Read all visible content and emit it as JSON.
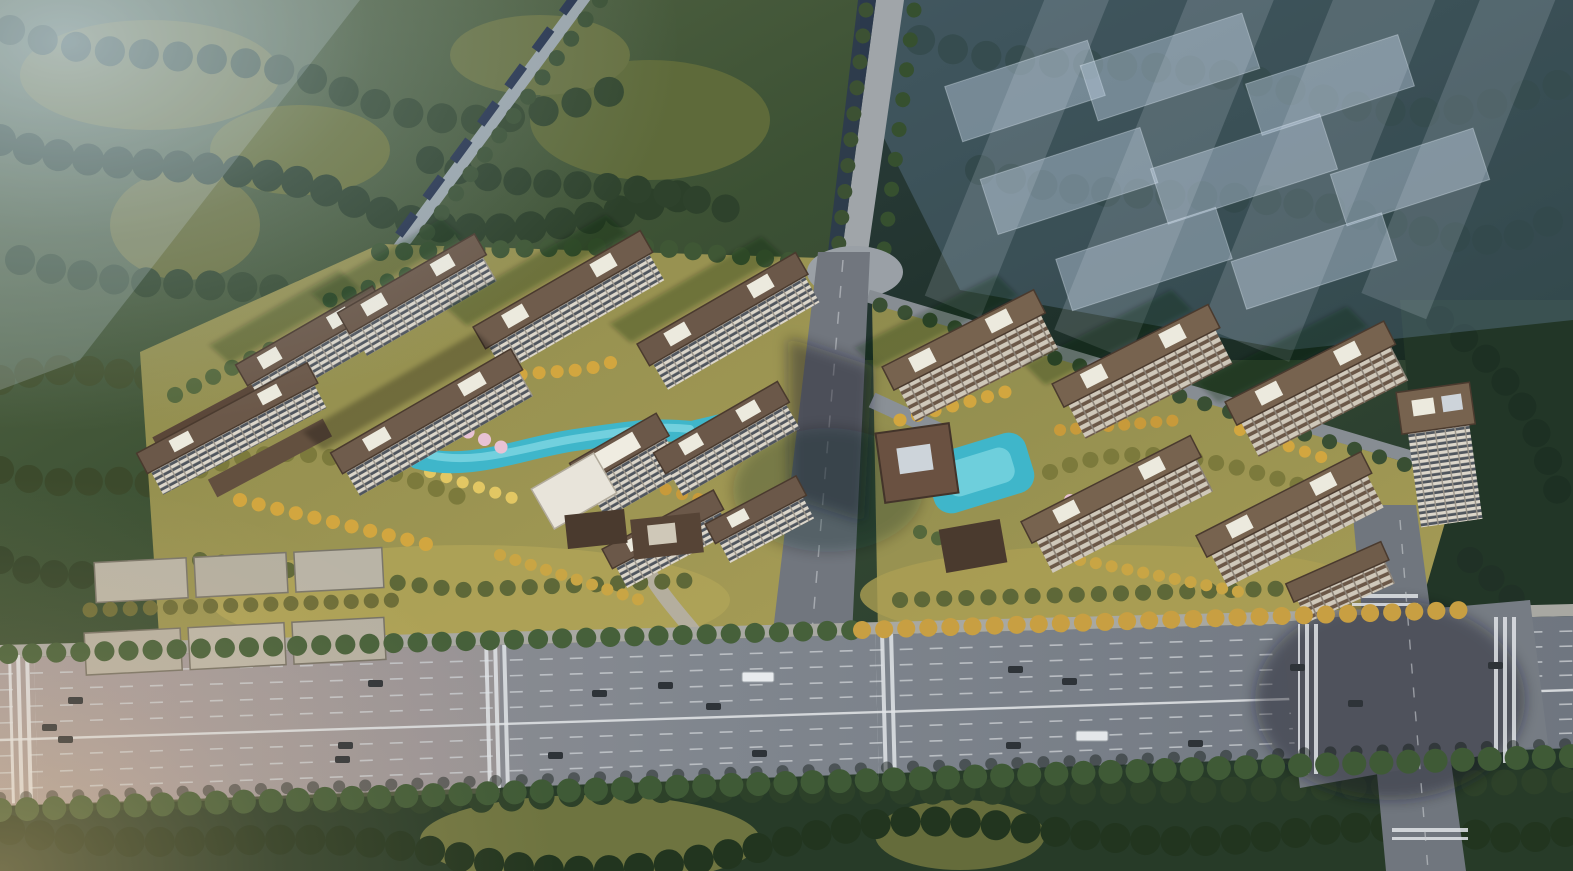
{
  "scene": {
    "type": "aerial-architectural-rendering",
    "description": "Bird's-eye architectural rendering of a two-parcel high-rise residential development surrounded by forest, with landscaped courtyards, turquoise pools, a tree-lined boulevard with traffic across the foreground, a central access road between the parcels, and translucent future-phase building massing at the upper right",
    "setting": "suburban greenfield site with dense tree cover and hazy light from the upper left",
    "clusters": {
      "left": {
        "label": "west residential parcel",
        "tower_count": 10,
        "low_rise_rows": 2,
        "amenities": [
          "meandering turquoise pool",
          "pink blossom trees",
          "yellow autumn trees",
          "south entrance pavilion",
          "white podium roofs"
        ]
      },
      "right": {
        "label": "east residential parcel",
        "tower_count": 7,
        "amenities": [
          "central swimming pool",
          "clubhouse pavilion",
          "gate pavilion",
          "yellow autumn trees",
          "pink blossom trees"
        ]
      }
    },
    "roads": {
      "foreground_boulevard": "wide multi-lane arterial running left to right with dashed lane markings, median line, crosswalks and traffic",
      "central_access_road": "north-south road separating the two parcels, partially in building shadow",
      "north_road": "tree-lined road with canal entering from the top edge",
      "east_intersection": "large shadowed crossroads at the lower right with zebra crossings"
    },
    "vehicles": {
      "cars": 18,
      "trucks": 1,
      "buses": 1
    },
    "ghost_buildings": {
      "label": "translucent future-phase massing",
      "block_count": 8
    },
    "palette": {
      "forest_dark": "#243626",
      "forest_olive": "#50603a",
      "meadow": "#6e7440",
      "parcel_lawn": "#9b9753",
      "autumn_tree": "#d2a63f",
      "pale_autumn": "#e2c763",
      "blossom": "#e8c2d4",
      "pool": "#3fb6ca",
      "asphalt": "#7e848c",
      "asphalt_shadow": "#4a505c",
      "roof_brown": "#6b5849",
      "roof_dark": "#4a3a2e",
      "facade_white": "#dad5c9",
      "ghost_blue": "#b9c9da",
      "haze": "#c8d8e8"
    }
  }
}
